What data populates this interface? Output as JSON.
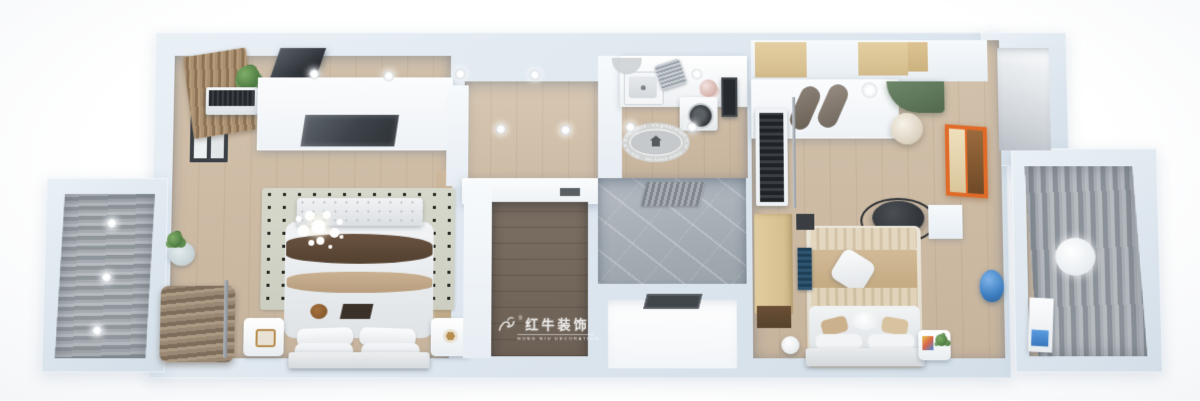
{
  "watermark": {
    "logo": "bull-logo",
    "registered_mark": "®",
    "brand": "红牛装饰",
    "tagline": "HONG NIU DECORATION"
  },
  "kitchen": {
    "rug_border_text": "a great place it is · enjoy every life · this is a great place · enjoy every life ·"
  },
  "palette": {
    "wall": "#dde6ee",
    "wall_face": "#f7fafc",
    "floor_oak": "#cbb9a3",
    "floor_dark_closet": "#6f6256",
    "marble": "#a9b0b7",
    "curtain_gray": "#9aa1a7",
    "canopy_green": "#5d7559",
    "painting_orange": "#e06a28",
    "vase_blue": "#3e7fc1",
    "chair_charcoal": "#383c41",
    "runner_brown": "#5c4533",
    "runner_tan": "#c2a98a"
  }
}
